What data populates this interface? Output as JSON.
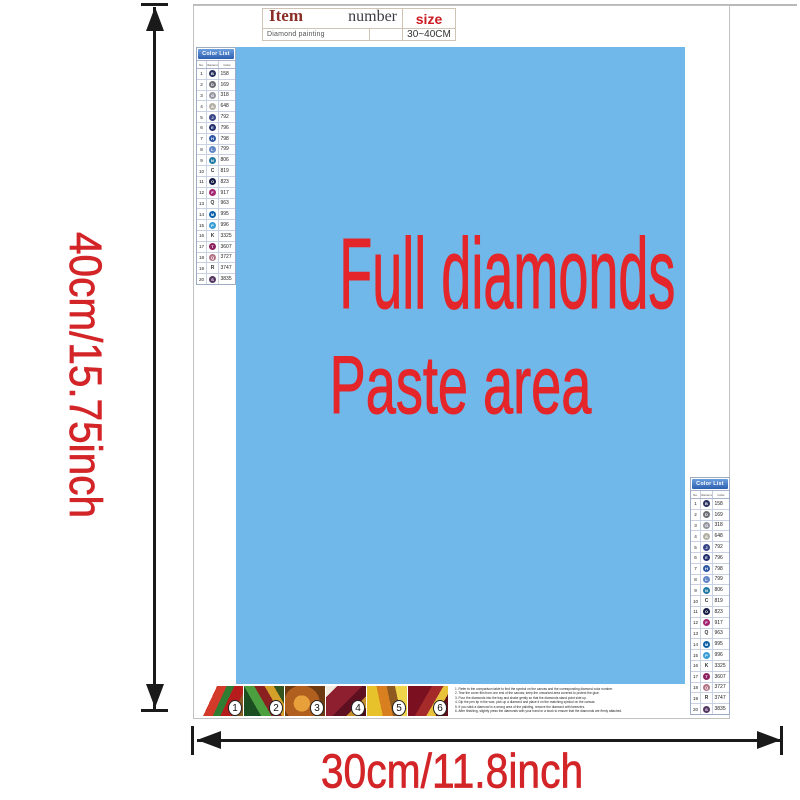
{
  "info_table": {
    "item_label": "Item",
    "number_label": "number",
    "size_label": "size",
    "item_value": "Diamond painting",
    "number_value": "",
    "size_value": "30~40CM"
  },
  "paste_area": {
    "line1": "Full diamonds",
    "line2": "Paste area",
    "bg_color": "#6fb8e9",
    "text_color": "#e4262b"
  },
  "dimensions": {
    "height_label": "40cm/15.75inch",
    "width_label": "30cm/11.8inch",
    "label_color": "#d32428",
    "arrow_color": "#1a1a1a"
  },
  "color_list": {
    "title": "Color List",
    "columns": [
      "No.",
      "Diamond",
      "Color"
    ],
    "rows": [
      {
        "no": "1",
        "symbol": "B",
        "code": "158",
        "swatch": "#29305e",
        "circle": true
      },
      {
        "no": "2",
        "symbol": "D",
        "code": "169",
        "swatch": "#6d6d77",
        "circle": true
      },
      {
        "no": "3",
        "symbol": "G",
        "code": "318",
        "swatch": "#9597a1",
        "circle": true
      },
      {
        "no": "4",
        "symbol": "A",
        "code": "648",
        "swatch": "#b2afa4",
        "circle": true
      },
      {
        "no": "5",
        "symbol": "J",
        "code": "792",
        "swatch": "#3a4687",
        "circle": true
      },
      {
        "no": "6",
        "symbol": "E",
        "code": "796",
        "swatch": "#22306e",
        "circle": true
      },
      {
        "no": "7",
        "symbol": "H",
        "code": "798",
        "swatch": "#2e57a3",
        "circle": true
      },
      {
        "no": "8",
        "symbol": "L",
        "code": "799",
        "swatch": "#6286c5",
        "circle": true
      },
      {
        "no": "9",
        "symbol": "N",
        "code": "806",
        "swatch": "#2079a3",
        "circle": true
      },
      {
        "no": "10",
        "symbol": "C",
        "code": "819",
        "swatch": null,
        "circle": false
      },
      {
        "no": "11",
        "symbol": "O",
        "code": "823",
        "swatch": "#141b44",
        "circle": true
      },
      {
        "no": "12",
        "symbol": "F",
        "code": "917",
        "swatch": "#a42470",
        "circle": true
      },
      {
        "no": "13",
        "symbol": "Q",
        "code": "963",
        "swatch": null,
        "circle": false
      },
      {
        "no": "14",
        "symbol": "M",
        "code": "995",
        "swatch": "#0d61a9",
        "circle": true
      },
      {
        "no": "15",
        "symbol": "P",
        "code": "996",
        "swatch": "#3a9ed6",
        "circle": true
      },
      {
        "no": "16",
        "symbol": "K",
        "code": "3325",
        "swatch": null,
        "circle": false
      },
      {
        "no": "17",
        "symbol": "T",
        "code": "3607",
        "swatch": "#8d2160",
        "circle": true
      },
      {
        "no": "18",
        "symbol": "Q",
        "code": "3727",
        "swatch": "#b27588",
        "circle": true
      },
      {
        "no": "19",
        "symbol": "R",
        "code": "3747",
        "swatch": null,
        "circle": false
      },
      {
        "no": "20",
        "symbol": "S",
        "code": "3835",
        "swatch": "#523561",
        "circle": true
      }
    ]
  },
  "steps": {
    "numbers": [
      "1",
      "2",
      "3",
      "4",
      "5",
      "6"
    ]
  },
  "instructions": {
    "lines": [
      "1. Refer to the comparison table to find the symbol on the canvas and the corresponding diamond color number.",
      "2. Tear the cover film from one end of the canvas; keep the unworked area covered to protect the glue.",
      "3. Pour the diamonds into the tray and shake gently so that the diamonds stand point side up.",
      "4. Dip the pen tip in the wax, pick up a diamond and place it on the matching symbol on the canvas.",
      "5. If you stick a diamond in a wrong area of the painting, remove the diamond with tweezers.",
      "6. After finishing, slightly press the diamonds with your hand or a book to ensure that the diamonds are firmly attached."
    ]
  }
}
